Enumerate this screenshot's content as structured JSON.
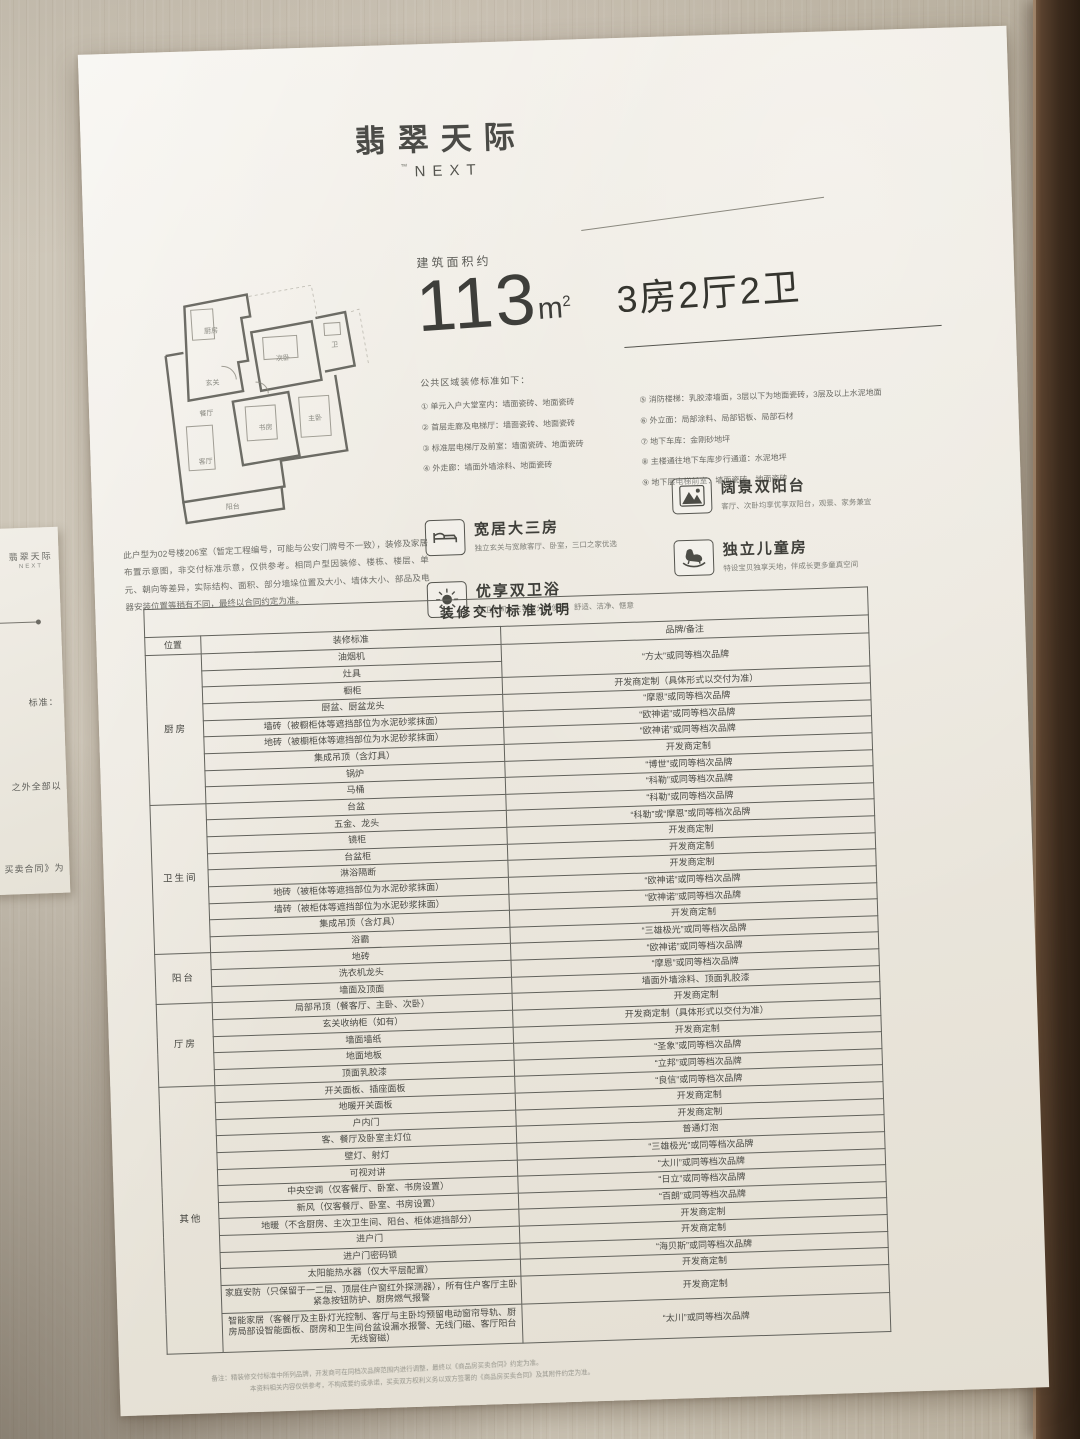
{
  "logo": {
    "cn": "翡翠天际",
    "mark": "™",
    "en": "NEXT"
  },
  "left_sign": {
    "logo_cn": "翡翠天际",
    "logo_en": "NEXT",
    "fragments": [
      "标准：",
      "之外全部以",
      "买卖合同》为"
    ]
  },
  "spec": {
    "caption": "建筑面积约",
    "area": "113",
    "unit": "m",
    "unit_sup": "2",
    "layout": "3房2厅2卫"
  },
  "public_area": {
    "title": "公共区域装修标准如下：",
    "left": [
      "① 单元入户大堂室内：墙面瓷砖、地面瓷砖",
      "② 首层走廊及电梯厅：墙面瓷砖、地面瓷砖",
      "③ 标准层电梯厅及前室：墙面瓷砖、地面瓷砖",
      "④ 外走廊：墙面外墙涂料、地面瓷砖"
    ],
    "right": [
      "⑤ 消防楼梯：乳胶漆墙面，3层以下为地面瓷砖，3层及以上水泥地面",
      "⑥ 外立面：局部涂料、局部铝板、局部石材",
      "⑦ 地下车库：金刚砂地坪",
      "⑧ 主楼通往地下车库步行通道：水泥地坪",
      "⑨ 地下层电梯前室：墙面瓷砖、地面瓷砖"
    ]
  },
  "features": [
    {
      "title": "宽居大三房",
      "desc": "独立玄关与宽敞客厅、卧室，三口之家优选",
      "icon": "bed-icon"
    },
    {
      "title": "优享双卫浴",
      "desc": "双卫生间，主客双分开使用，舒适、洁净、惬意",
      "icon": "sun-icon"
    },
    {
      "title": "阔景双阳台",
      "desc": "客厅、次卧均享优享双阳台，观景、家务兼宜",
      "icon": "mountain-icon"
    },
    {
      "title": "独立儿童房",
      "desc": "特设宝贝独享天地，伴成长更多童真空间",
      "icon": "rocking-horse-icon"
    }
  ],
  "disclaimer": "此户型为02号楼206室（暂定工程编号，可能与公安门牌号不一致），装修及家居布置示意图，非交付标准示意，仅供参考。相同户型因装修、楼栋、楼层、单元、朝向等差异，实际结构、面积、部分墙垛位置及大小、墙体大小、部品及电器安装位置等稍有不同，最终以合同约定为准。",
  "floorplan": {
    "rooms": [
      "厨房",
      "玄关",
      "次卧",
      "卫",
      "餐厅",
      "书房",
      "客厅",
      "主卧",
      "阳台"
    ]
  },
  "table": {
    "title": "装修交付标准说明",
    "col_headers": [
      "位置",
      "装修标准",
      "品牌/备注"
    ],
    "sections": [
      {
        "category": "厨房",
        "rows": [
          {
            "item": "油烟机",
            "brand": "“方太”或同等档次品牌",
            "brand_rowspan": 2
          },
          {
            "item": "灶具",
            "brand": null
          },
          {
            "item": "橱柜",
            "brand": "开发商定制（具体形式以交付为准）"
          },
          {
            "item": "厨盆、厨盆龙头",
            "brand": "“摩恩”或同等档次品牌"
          },
          {
            "item": "墙砖（被橱柜体等遮挡部位为水泥砂浆抹面）",
            "brand": "“欧神诺”或同等档次品牌"
          },
          {
            "item": "地砖（被橱柜体等遮挡部位为水泥砂浆抹面）",
            "brand": "“欧神诺”或同等档次品牌"
          },
          {
            "item": "集成吊顶（含灯具）",
            "brand": "开发商定制"
          },
          {
            "item": "锅炉",
            "brand": "“博世”或同等档次品牌"
          },
          {
            "item": "马桶",
            "brand": "“科勒”或同等档次品牌"
          }
        ]
      },
      {
        "category": "卫生间",
        "rows": [
          {
            "item": "台盆",
            "brand": "“科勒”或同等档次品牌"
          },
          {
            "item": "五金、龙头",
            "brand": "“科勒”或“摩恩”或同等档次品牌"
          },
          {
            "item": "镜柜",
            "brand": "开发商定制"
          },
          {
            "item": "台盆柜",
            "brand": "开发商定制"
          },
          {
            "item": "淋浴隔断",
            "brand": "开发商定制"
          },
          {
            "item": "地砖（被柜体等遮挡部位为水泥砂浆抹面）",
            "brand": "“欧神诺”或同等档次品牌"
          },
          {
            "item": "墙砖（被柜体等遮挡部位为水泥砂浆抹面）",
            "brand": "“欧神诺”或同等档次品牌"
          },
          {
            "item": "集成吊顶（含灯具）",
            "brand": "开发商定制"
          },
          {
            "item": "浴霸",
            "brand": "“三雄极光”或同等档次品牌"
          }
        ]
      },
      {
        "category": "阳台",
        "rows": [
          {
            "item": "地砖",
            "brand": "“欧神诺”或同等档次品牌"
          },
          {
            "item": "洗衣机龙头",
            "brand": "“摩恩”或同等档次品牌"
          },
          {
            "item": "墙面及顶面",
            "brand": "墙面外墙涂料、顶面乳胶漆"
          }
        ]
      },
      {
        "category": "厅房",
        "rows": [
          {
            "item": "局部吊顶（餐客厅、主卧、次卧）",
            "brand": "开发商定制"
          },
          {
            "item": "玄关收纳柜（如有）",
            "brand": "开发商定制（具体形式以交付为准）"
          },
          {
            "item": "墙面墙纸",
            "brand": "开发商定制"
          },
          {
            "item": "地面地板",
            "brand": "“圣象”或同等档次品牌"
          },
          {
            "item": "顶面乳胶漆",
            "brand": "“立邦”或同等档次品牌"
          }
        ]
      },
      {
        "category": "其他",
        "rows": [
          {
            "item": "开关面板、插座面板",
            "brand": "“良信”或同等档次品牌"
          },
          {
            "item": "地暖开关面板",
            "brand": "开发商定制"
          },
          {
            "item": "户内门",
            "brand": "开发商定制"
          },
          {
            "item": "客、餐厅及卧室主灯位",
            "brand": "普通灯泡"
          },
          {
            "item": "壁灯、射灯",
            "brand": "“三雄极光”或同等档次品牌"
          },
          {
            "item": "可视对讲",
            "brand": "“太川”或同等档次品牌"
          },
          {
            "item": "中央空调（仅客餐厅、卧室、书房设置）",
            "brand": "“日立”或同等档次品牌"
          },
          {
            "item": "新风（仅客餐厅、卧室、书房设置）",
            "brand": "“百朗”或同等档次品牌"
          },
          {
            "item": "地暖（不含厨房、主次卫生间、阳台、柜体遮挡部分）",
            "brand": "开发商定制"
          },
          {
            "item": "进户门",
            "brand": "开发商定制"
          },
          {
            "item": "进户门密码锁",
            "brand": "“海贝斯”或同等档次品牌"
          },
          {
            "item": "太阳能热水器（仅大平层配置）",
            "brand": "开发商定制"
          },
          {
            "item": "家庭安防（只保留于一二层、顶层住户窗红外探测器），所有住户客厅主卧紧急按钮防护、厨房燃气报警",
            "brand": "开发商定制"
          },
          {
            "item": "智能家居（客餐厅及主卧灯光控制、客厅与主卧均预留电动窗帘导轨、厨房局部设智能面板、厨房和卫生间台盆设漏水报警、无线门磁、客厅阳台无线窗磁）",
            "brand": "“太川”或同等档次品牌"
          }
        ]
      }
    ]
  },
  "footnotes": [
    "备注：精装修交付标准中所列品牌，开发商可在同档次品牌范围内进行调整，最终以《商品房买卖合同》约定为准。",
    "本资料相关内容仅供参考，不构成要约或承诺，买卖双方权利义务以双方签署的《商品房买卖合同》及其附件约定为准。"
  ]
}
